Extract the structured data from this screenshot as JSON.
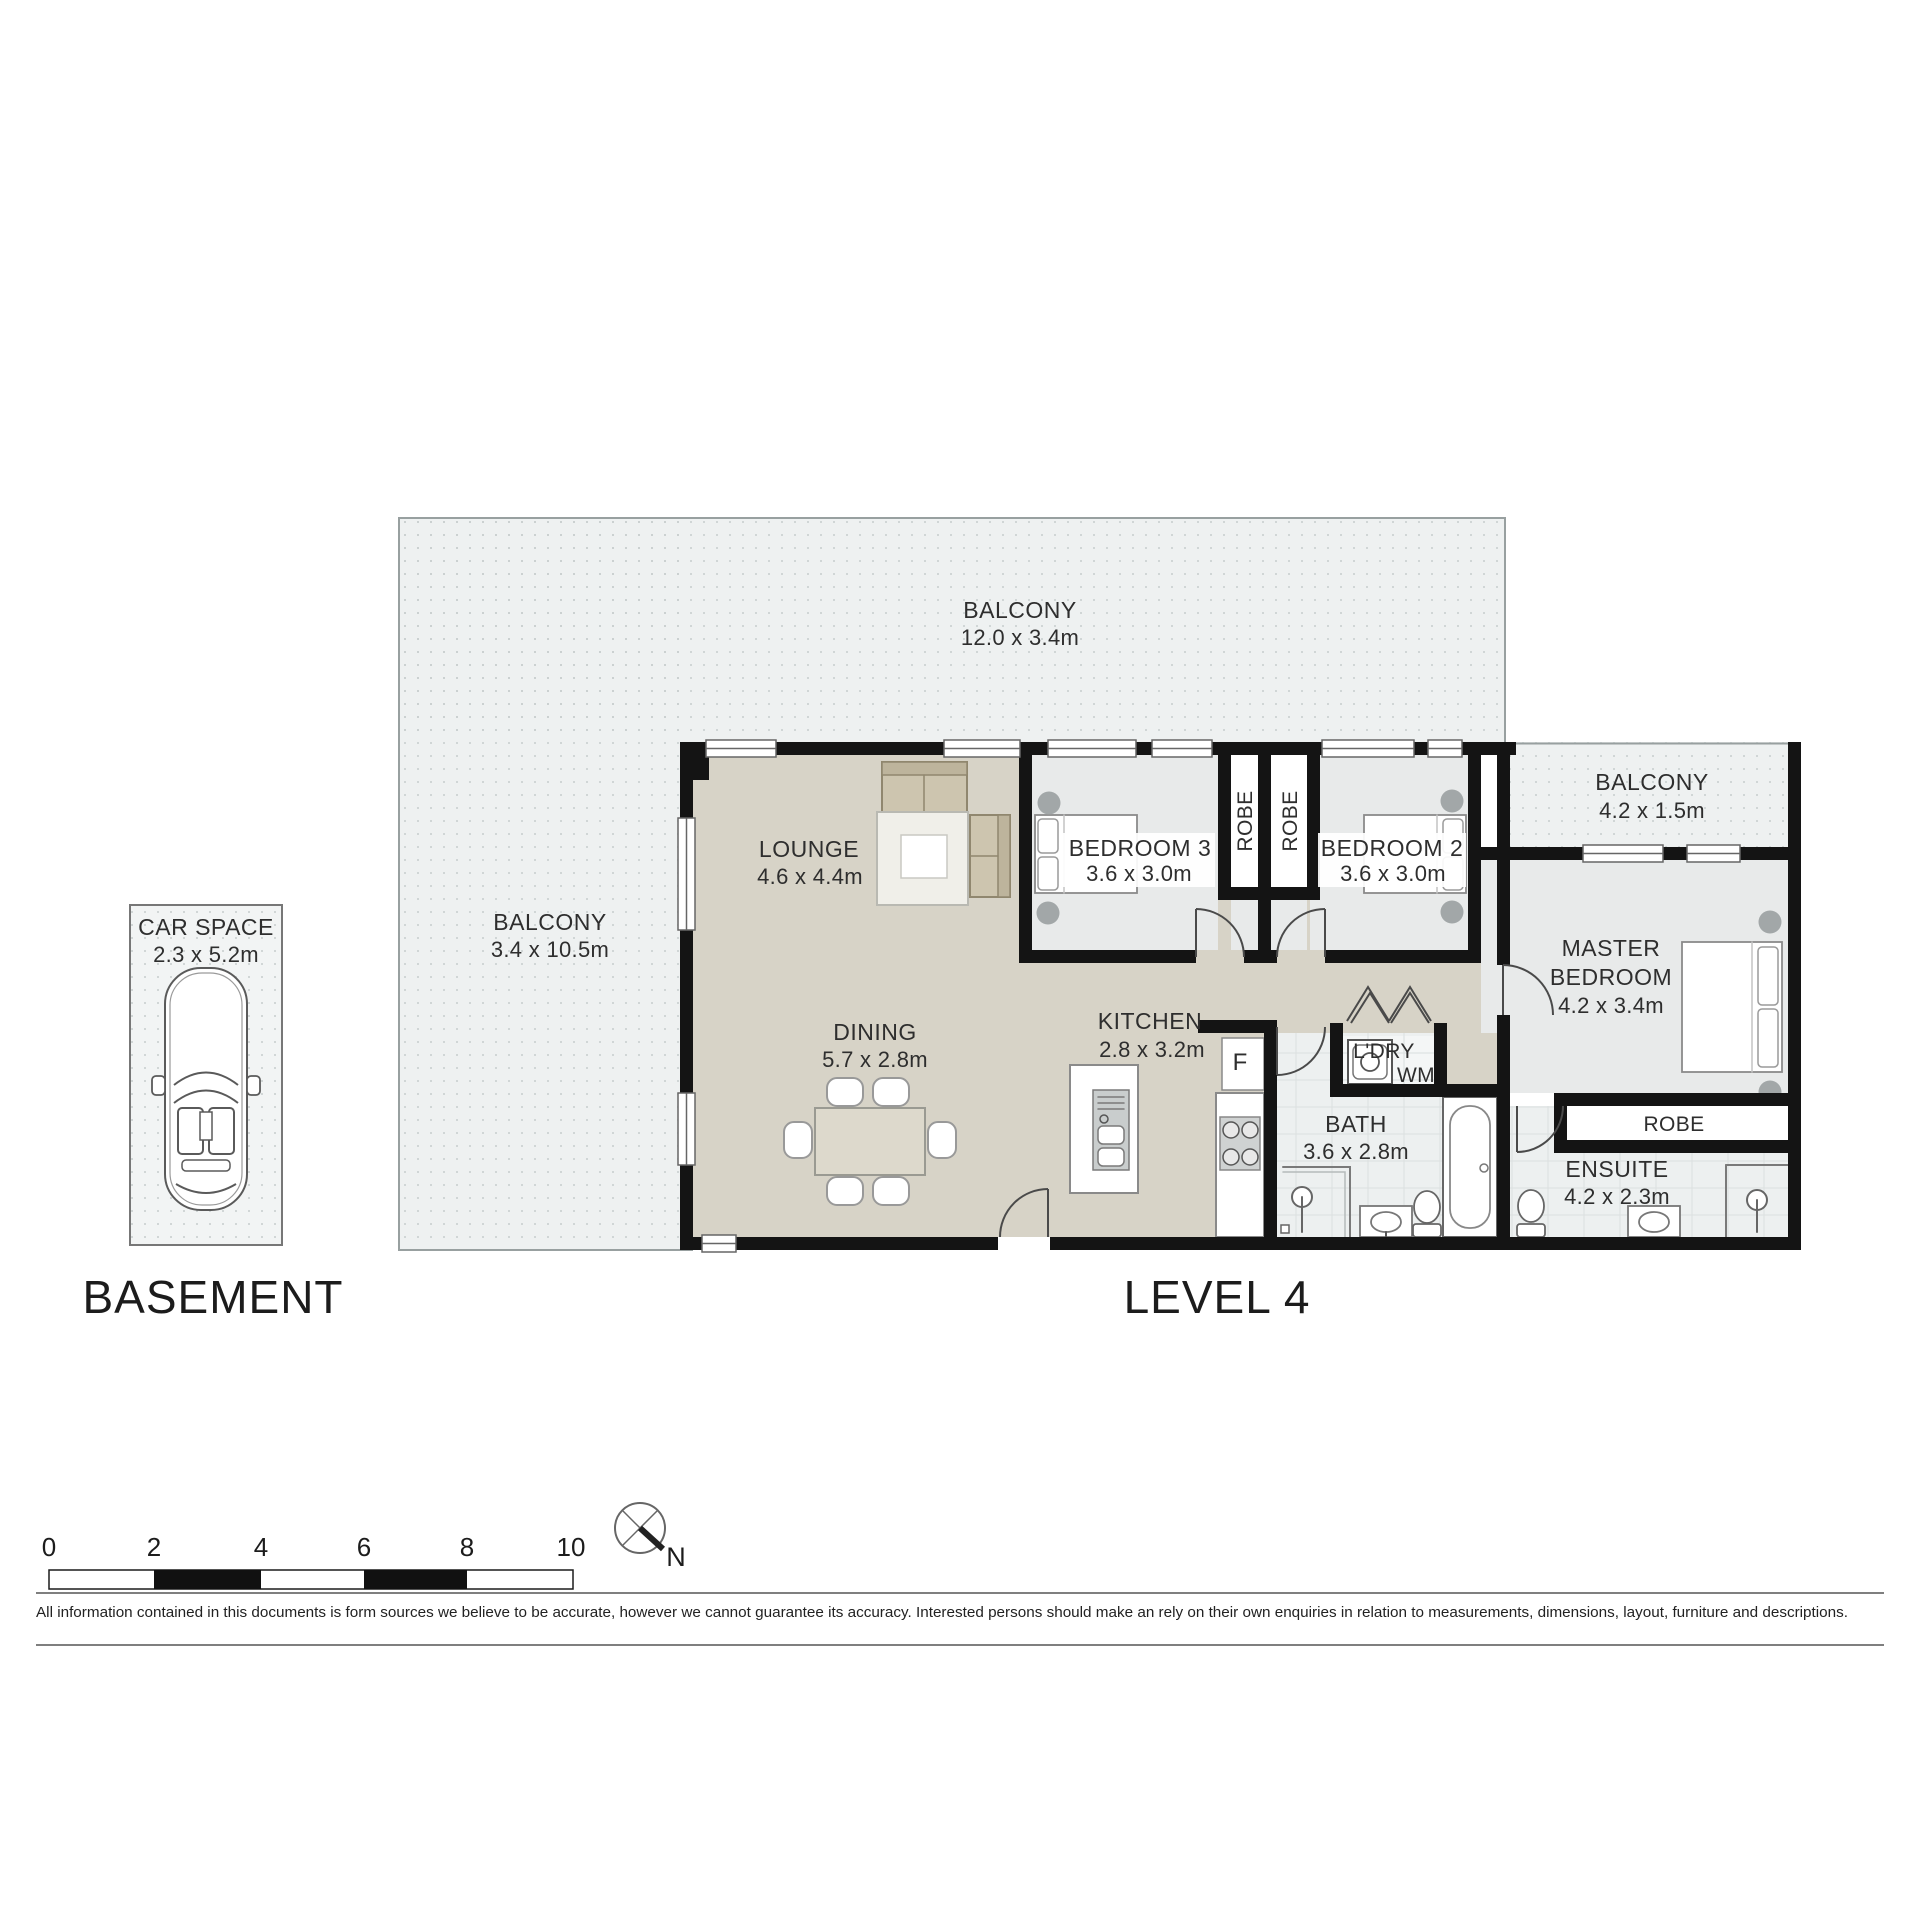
{
  "plan": {
    "balcony_top": {
      "name": "BALCONY",
      "dims": "12.0 x 3.4m"
    },
    "balcony_left": {
      "name": "BALCONY",
      "dims": "3.4 x 10.5m"
    },
    "balcony_right": {
      "name": "BALCONY",
      "dims": "4.2 x 1.5m"
    },
    "lounge": {
      "name": "LOUNGE",
      "dims": "4.6 x 4.4m"
    },
    "dining": {
      "name": "DINING",
      "dims": "5.7 x 2.8m"
    },
    "kitchen": {
      "name": "KITCHEN",
      "dims": "2.8 x 3.2m",
      "fridge": "F"
    },
    "bedroom3": {
      "name": "BEDROOM 3",
      "dims": "3.6 x 3.0m"
    },
    "bedroom2": {
      "name": "BEDROOM 2",
      "dims": "3.6 x 3.0m"
    },
    "master": {
      "name_line1": "MASTER",
      "name_line2": "BEDROOM",
      "dims": "4.2 x 3.4m"
    },
    "bath": {
      "name": "BATH",
      "dims": "3.6 x 2.8m"
    },
    "ensuite": {
      "name": "ENSUITE",
      "dims": "4.2 x 2.3m"
    },
    "laundry": {
      "name": "L'DRY",
      "appliance": "WM"
    },
    "robe_left": "ROBE",
    "robe_right": "ROBE",
    "robe_master": "ROBE",
    "car_space": {
      "name": "CAR SPACE",
      "dims": "2.3 x 5.2m"
    }
  },
  "floor_labels": {
    "basement": "BASEMENT",
    "level": "LEVEL 4"
  },
  "scale_bar": {
    "ticks": [
      "0",
      "2",
      "4",
      "6",
      "8",
      "10"
    ]
  },
  "compass": {
    "north": "N"
  },
  "disclaimer": "All information contained in this documents is form sources we believe to be accurate, however we cannot guarantee its accuracy. Interested persons should make an rely on their own enquiries in relation to measurements, dimensions, layout, furniture and descriptions.",
  "colors": {
    "wall": "#141414",
    "living_floor": "#d7d3c7",
    "bedroom_floor": "#e8eaea",
    "balcony_floor": "#eef1f1",
    "bathroom_floor": "#edf0f0",
    "furniture": "#cdc5af"
  }
}
